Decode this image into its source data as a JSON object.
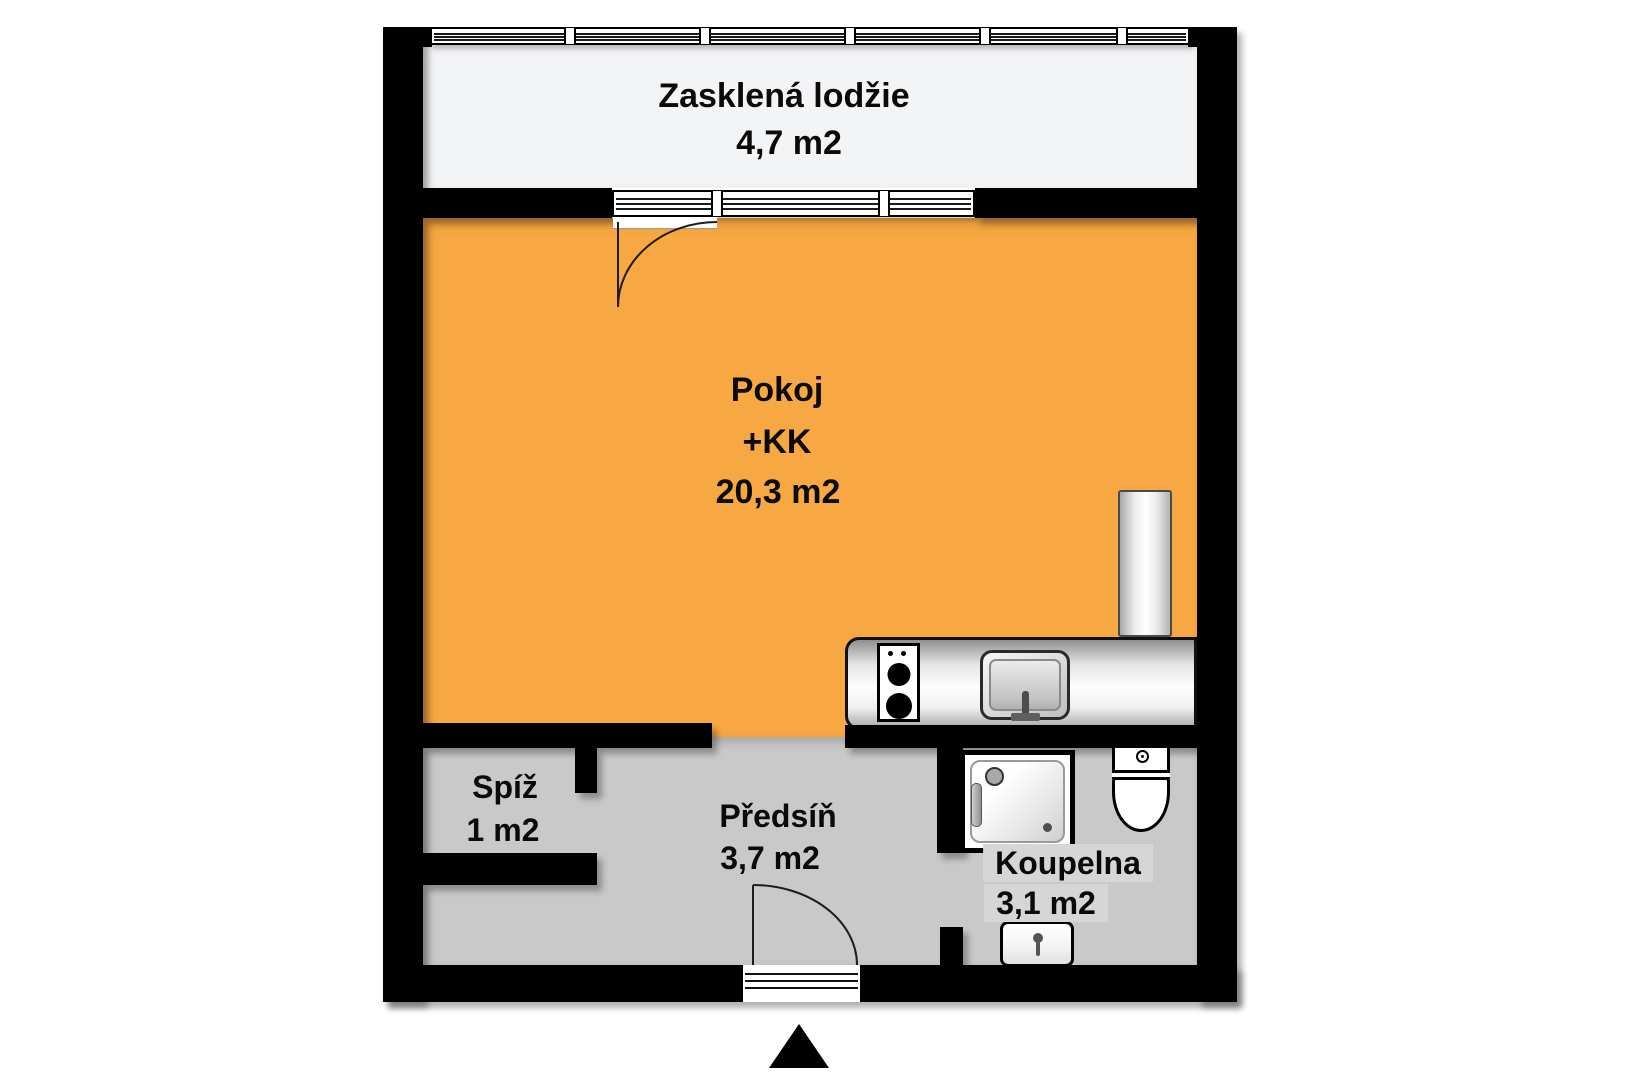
{
  "rooms": {
    "loggia": {
      "name": "Zasklená lodžie",
      "area": "4,7 m2"
    },
    "pokoj": {
      "name": "Pokoj",
      "kk": "+KK",
      "area": "20,3 m2"
    },
    "spiz": {
      "name": "Spíž",
      "area": "1 m2"
    },
    "predsin": {
      "name": "Předsíň",
      "area": "3,7 m2"
    },
    "koupelna": {
      "name": "Koupelna",
      "area": "3,1 m2"
    }
  },
  "icons": {
    "stove": "two-burner-cooktop",
    "kitchen_sink": "kitchen-sink",
    "tall_cabinet": "tall-cabinet-fridge",
    "shower": "shower-tray",
    "toilet": "toilet",
    "washbasin": "washbasin",
    "entrance_arrow": "entrance-direction-triangle"
  },
  "colors": {
    "room_fill": "#F7A842",
    "hall_fill": "#C9C9C9",
    "loggia_fill": "#F3F4F6",
    "wall": "#000000",
    "label_highlight": "#D6D6D6"
  }
}
